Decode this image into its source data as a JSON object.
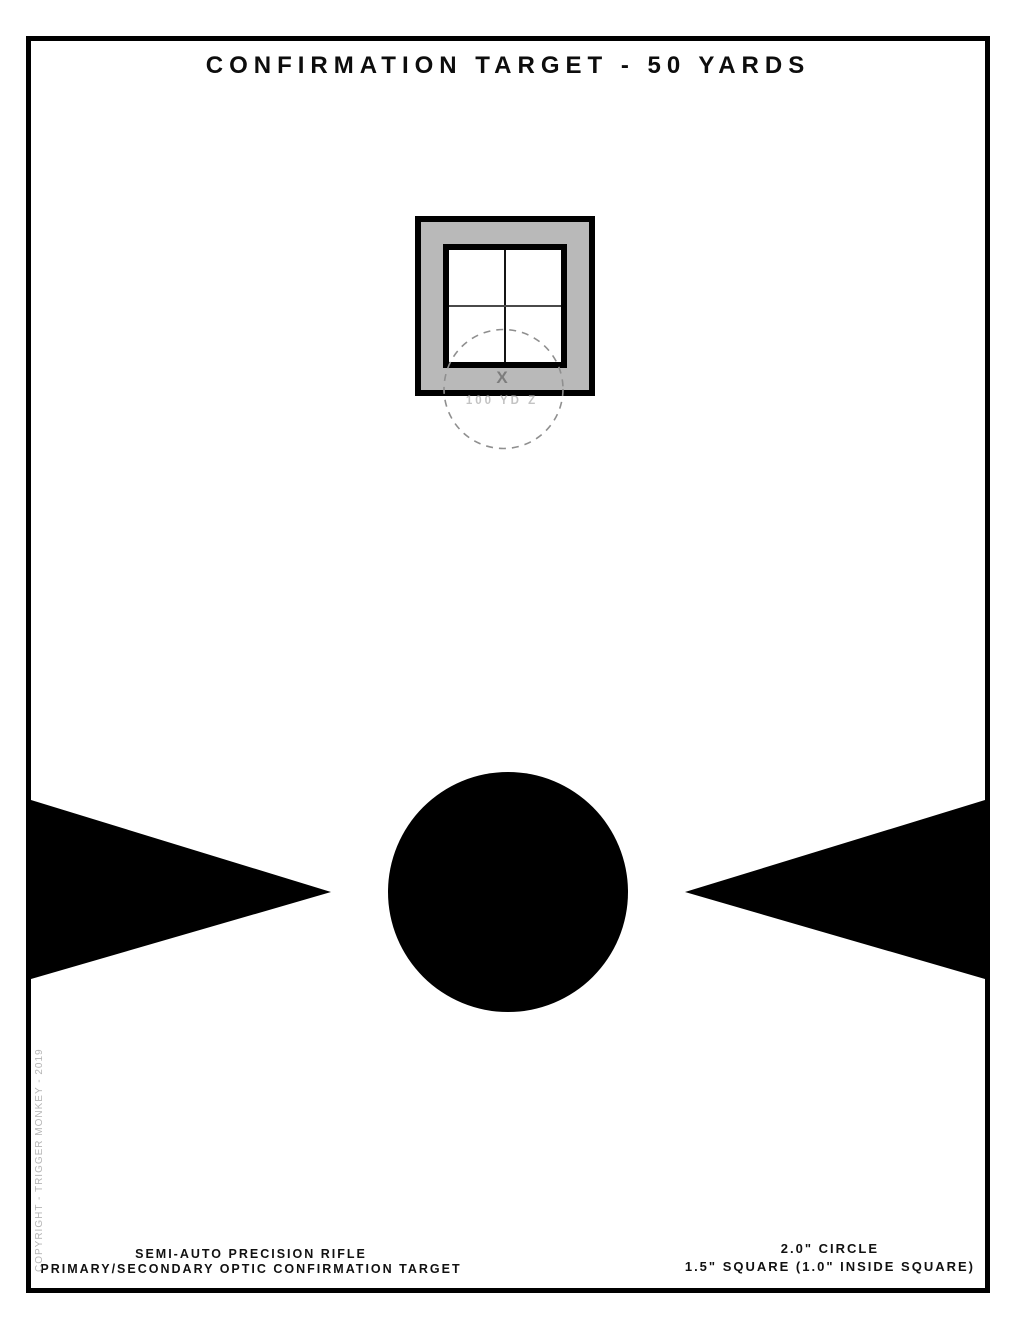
{
  "page": {
    "title": "CONFIRMATION TARGET - 50 YARDS",
    "copyright": "COPYRIGHT - TRIGGER MONKEY - 2019"
  },
  "zero_box": {
    "x_marker": "X",
    "zero_label": "100 YD Z"
  },
  "footer": {
    "left": {
      "line1": "SEMI-AUTO PRECISION RIFLE",
      "line2": "PRIMARY/SECONDARY OPTIC CONFIRMATION TARGET"
    },
    "right": {
      "line1": "2.0\" CIRCLE",
      "line2": "1.5\" SQUARE (1.0\" INSIDE SQUARE)"
    }
  },
  "colors": {
    "ink": "#000000",
    "square_fill": "#b9b9b9",
    "dashed_circle_stroke": "#8f8f8f",
    "x_marker_text": "#7d7d7d",
    "zero_label_text": "#c3c3c3",
    "copyright_text": "#b5b5b5"
  }
}
